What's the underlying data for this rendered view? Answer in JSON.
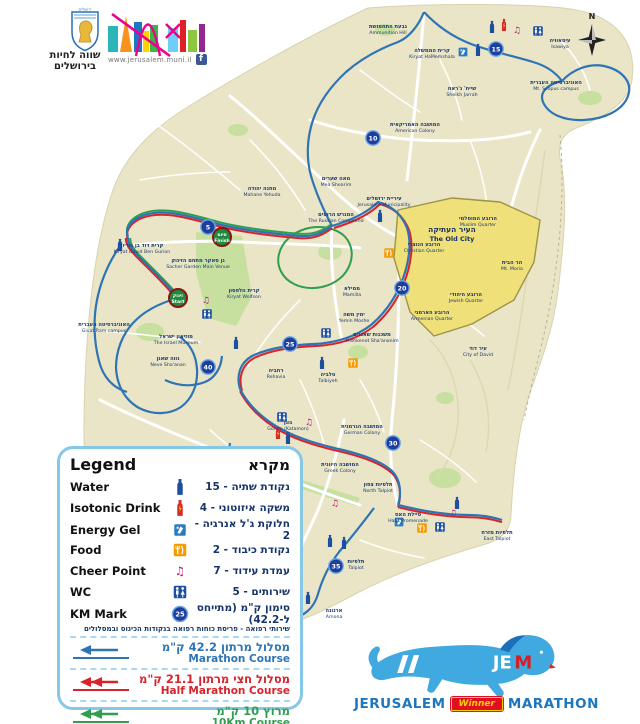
{
  "header": {
    "emblem_caption": "ירושלים",
    "muni_line1": "שווה לחיות",
    "muni_line2": "בירושלים",
    "url": "www.jerusalem.muni.il",
    "facebook_label": "f"
  },
  "compass": {
    "north_label": "N"
  },
  "legend": {
    "title_en": "Legend",
    "title_he": "מקרא",
    "km_sample": "25",
    "items": [
      {
        "icon": "water",
        "en": "Water",
        "he": "נקודת שתיה - 15"
      },
      {
        "icon": "isotonic",
        "en": "Isotonic Drink",
        "he": "משקה איזוטוני - 4"
      },
      {
        "icon": "gel",
        "en": "Energy Gel",
        "he": "חלוקת ג'ל אנרגיה - 2"
      },
      {
        "icon": "food",
        "en": "Food",
        "he": "נקודת כיבוד - 2"
      },
      {
        "icon": "cheer",
        "en": "Cheer Point",
        "he": "עמדת עידוד - 7"
      },
      {
        "icon": "wc",
        "en": "WC",
        "he": "שירותים - 5"
      },
      {
        "icon": "km",
        "en": "KM Mark",
        "he": "סימון ק\"מ (מתייחס ל-42.2)"
      }
    ],
    "footnote": "שירותי רפואה - פריסת כוחות רפואה בנקודות הכינוס ובמסלולים",
    "courses": [
      {
        "he": "מסלול מרתון 42.2 ק\"מ",
        "en": "Marathon Course",
        "color": "#2e74b5",
        "heads": 1
      },
      {
        "he": "מסלול חצי מרתון 21.1 ק\"מ",
        "en": "Half Marathon Course",
        "color": "#d8232a",
        "heads": 2
      },
      {
        "he": "מרוץ 10 ק\"מ",
        "en": "10Km Course",
        "color": "#2f9e4f",
        "heads": 2
      }
    ]
  },
  "jem": {
    "je": "JE",
    "m": "M",
    "word1": "JERUSALEM",
    "word2": "Winner",
    "word3": "MARATHON"
  },
  "map": {
    "old_city": {
      "he": "העיר העתיקה",
      "en": "The Old City"
    },
    "badges": [
      {
        "he": "זינוק",
        "en": "Start",
        "x": 178,
        "y": 298
      },
      {
        "he": "סיום",
        "en": "Finish",
        "x": 222,
        "y": 237
      }
    ],
    "km_marks": [
      {
        "n": "5",
        "x": 208,
        "y": 227
      },
      {
        "n": "10",
        "x": 373,
        "y": 138
      },
      {
        "n": "15",
        "x": 496,
        "y": 49
      },
      {
        "n": "20",
        "x": 402,
        "y": 288
      },
      {
        "n": "25",
        "x": 290,
        "y": 344
      },
      {
        "n": "30",
        "x": 393,
        "y": 443
      },
      {
        "n": "35",
        "x": 336,
        "y": 566
      },
      {
        "n": "40",
        "x": 208,
        "y": 367
      }
    ],
    "icons": [
      {
        "type": "water",
        "x": 492,
        "y": 27
      },
      {
        "type": "isotonic",
        "x": 504,
        "y": 25
      },
      {
        "type": "cheer",
        "x": 517,
        "y": 30
      },
      {
        "type": "wc",
        "x": 538,
        "y": 31
      },
      {
        "type": "water",
        "x": 478,
        "y": 50
      },
      {
        "type": "gel",
        "x": 463,
        "y": 52
      },
      {
        "type": "water",
        "x": 380,
        "y": 216
      },
      {
        "type": "food",
        "x": 389,
        "y": 253
      },
      {
        "type": "water",
        "x": 120,
        "y": 245
      },
      {
        "type": "cheer",
        "x": 206,
        "y": 300
      },
      {
        "type": "wc",
        "x": 207,
        "y": 314
      },
      {
        "type": "water",
        "x": 236,
        "y": 343
      },
      {
        "type": "wc",
        "x": 326,
        "y": 333
      },
      {
        "type": "water",
        "x": 322,
        "y": 363
      },
      {
        "type": "food",
        "x": 353,
        "y": 363
      },
      {
        "type": "cheer",
        "x": 309,
        "y": 422
      },
      {
        "type": "wc",
        "x": 282,
        "y": 417
      },
      {
        "type": "isotonic",
        "x": 278,
        "y": 433
      },
      {
        "type": "water",
        "x": 288,
        "y": 438
      },
      {
        "type": "cheer",
        "x": 335,
        "y": 503
      },
      {
        "type": "water",
        "x": 457,
        "y": 503
      },
      {
        "type": "cheer",
        "x": 453,
        "y": 513
      },
      {
        "type": "gel",
        "x": 399,
        "y": 522
      },
      {
        "type": "food",
        "x": 422,
        "y": 528
      },
      {
        "type": "wc",
        "x": 440,
        "y": 527
      },
      {
        "type": "water",
        "x": 330,
        "y": 541
      },
      {
        "type": "water",
        "x": 344,
        "y": 543
      },
      {
        "type": "water",
        "x": 308,
        "y": 598
      }
    ],
    "labels": [
      {
        "he": "גבעת התחמושת",
        "en": "Ammunition Hill",
        "x": 388,
        "y": 28
      },
      {
        "he": "קרית הממשלה",
        "en": "Kiryat HaMemshala",
        "x": 432,
        "y": 52
      },
      {
        "he": "שייח' ג'ראח",
        "en": "Sheikh Jarrah",
        "x": 462,
        "y": 90
      },
      {
        "he": "עיסאוויה",
        "en": "Isawiya",
        "x": 560,
        "y": 42
      },
      {
        "he": "האוניברסיטה העברית",
        "en": "Mt. Scopus campus",
        "x": 556,
        "y": 84
      },
      {
        "he": "המושבה האמריקאית",
        "en": "American Colony",
        "x": 415,
        "y": 126
      },
      {
        "he": "מאה שערים",
        "en": "Mea Shearim",
        "x": 336,
        "y": 180
      },
      {
        "he": "מחנה יהודה",
        "en": "Mahane Yehuda",
        "x": 262,
        "y": 190
      },
      {
        "he": "המגרש הרוסים",
        "en": "The Russian Compound",
        "x": 336,
        "y": 216
      },
      {
        "he": "עיריית ירושלים",
        "en": "Jerusalem Municipality",
        "x": 384,
        "y": 200
      },
      {
        "he": "ממילא",
        "en": "Mamilla",
        "x": 352,
        "y": 290
      },
      {
        "he": "ימין משה",
        "en": "Yemin Moshe",
        "x": 354,
        "y": 316
      },
      {
        "he": "משכנות שאננים",
        "en": "Mishkenot Sha'ananim",
        "x": 372,
        "y": 336
      },
      {
        "he": "קרית וולפסון",
        "en": "Kiryat Wolfson",
        "x": 244,
        "y": 292
      },
      {
        "he": "קרית דוד בן גוריון",
        "en": "Kiryat David Ben Gurion",
        "x": 142,
        "y": 247
      },
      {
        "he": "גן סאקר מתחם הזינוק",
        "en": "Sacher Garden Main Venue",
        "x": 198,
        "y": 262
      },
      {
        "he": "האוניברסיטה העברית",
        "en": "Givat Ram campus",
        "x": 104,
        "y": 326
      },
      {
        "he": "מוזיאון ישראל",
        "en": "The Israel Museum",
        "x": 176,
        "y": 338
      },
      {
        "he": "נווה שאנן",
        "en": "Neve Sha'anan",
        "x": 168,
        "y": 360
      },
      {
        "he": "רחביה",
        "en": "Rehavia",
        "x": 276,
        "y": 372
      },
      {
        "he": "טלביה",
        "en": "Talbiyeh",
        "x": 328,
        "y": 376
      },
      {
        "he": "גונן",
        "en": "Gonen (Katamon)",
        "x": 288,
        "y": 424
      },
      {
        "he": "המושבה הגרמנית",
        "en": "German Colony",
        "x": 362,
        "y": 428
      },
      {
        "he": "המושבה היוונית",
        "en": "Greek Colony",
        "x": 340,
        "y": 466
      },
      {
        "he": "תלפיות צפון",
        "en": "North Talpiot",
        "x": 378,
        "y": 486
      },
      {
        "he": "טיילת האס",
        "en": "Haas Promenade",
        "x": 408,
        "y": 516
      },
      {
        "he": "תלפיות מזרח",
        "en": "East Talpiot",
        "x": 497,
        "y": 534
      },
      {
        "he": "תלפיות",
        "en": "Talpiot",
        "x": 356,
        "y": 563
      },
      {
        "he": "ארנונה",
        "en": "Arnona",
        "x": 334,
        "y": 612
      },
      {
        "he": "עיר דוד",
        "en": "City of David",
        "x": 478,
        "y": 350
      },
      {
        "he": "הרובע המוסלמי",
        "en": "Muslim Quarter",
        "x": 478,
        "y": 220
      },
      {
        "he": "הרובע הנוצרי",
        "en": "Christian Quarter",
        "x": 424,
        "y": 246
      },
      {
        "he": "הר הבית",
        "en": "Mt. Moria",
        "x": 512,
        "y": 264
      },
      {
        "he": "הרובע היהודי",
        "en": "Jewish Quarter",
        "x": 466,
        "y": 296
      },
      {
        "he": "הרובע הארמני",
        "en": "Armenian Quarter",
        "x": 432,
        "y": 314
      }
    ]
  },
  "colors": {
    "marathon": "#2e74b5",
    "half": "#d8232a",
    "tenk": "#2f9e4f",
    "land": "#e9e5c6",
    "park": "#c7e0a0",
    "old_city": "#efe079",
    "water": "#1d4fa0",
    "isotonic": "#d42a2a",
    "food": "#f59b00",
    "cheer": "#b5177e",
    "km": "#1c3f9e",
    "badge": "#1e8a3e"
  }
}
